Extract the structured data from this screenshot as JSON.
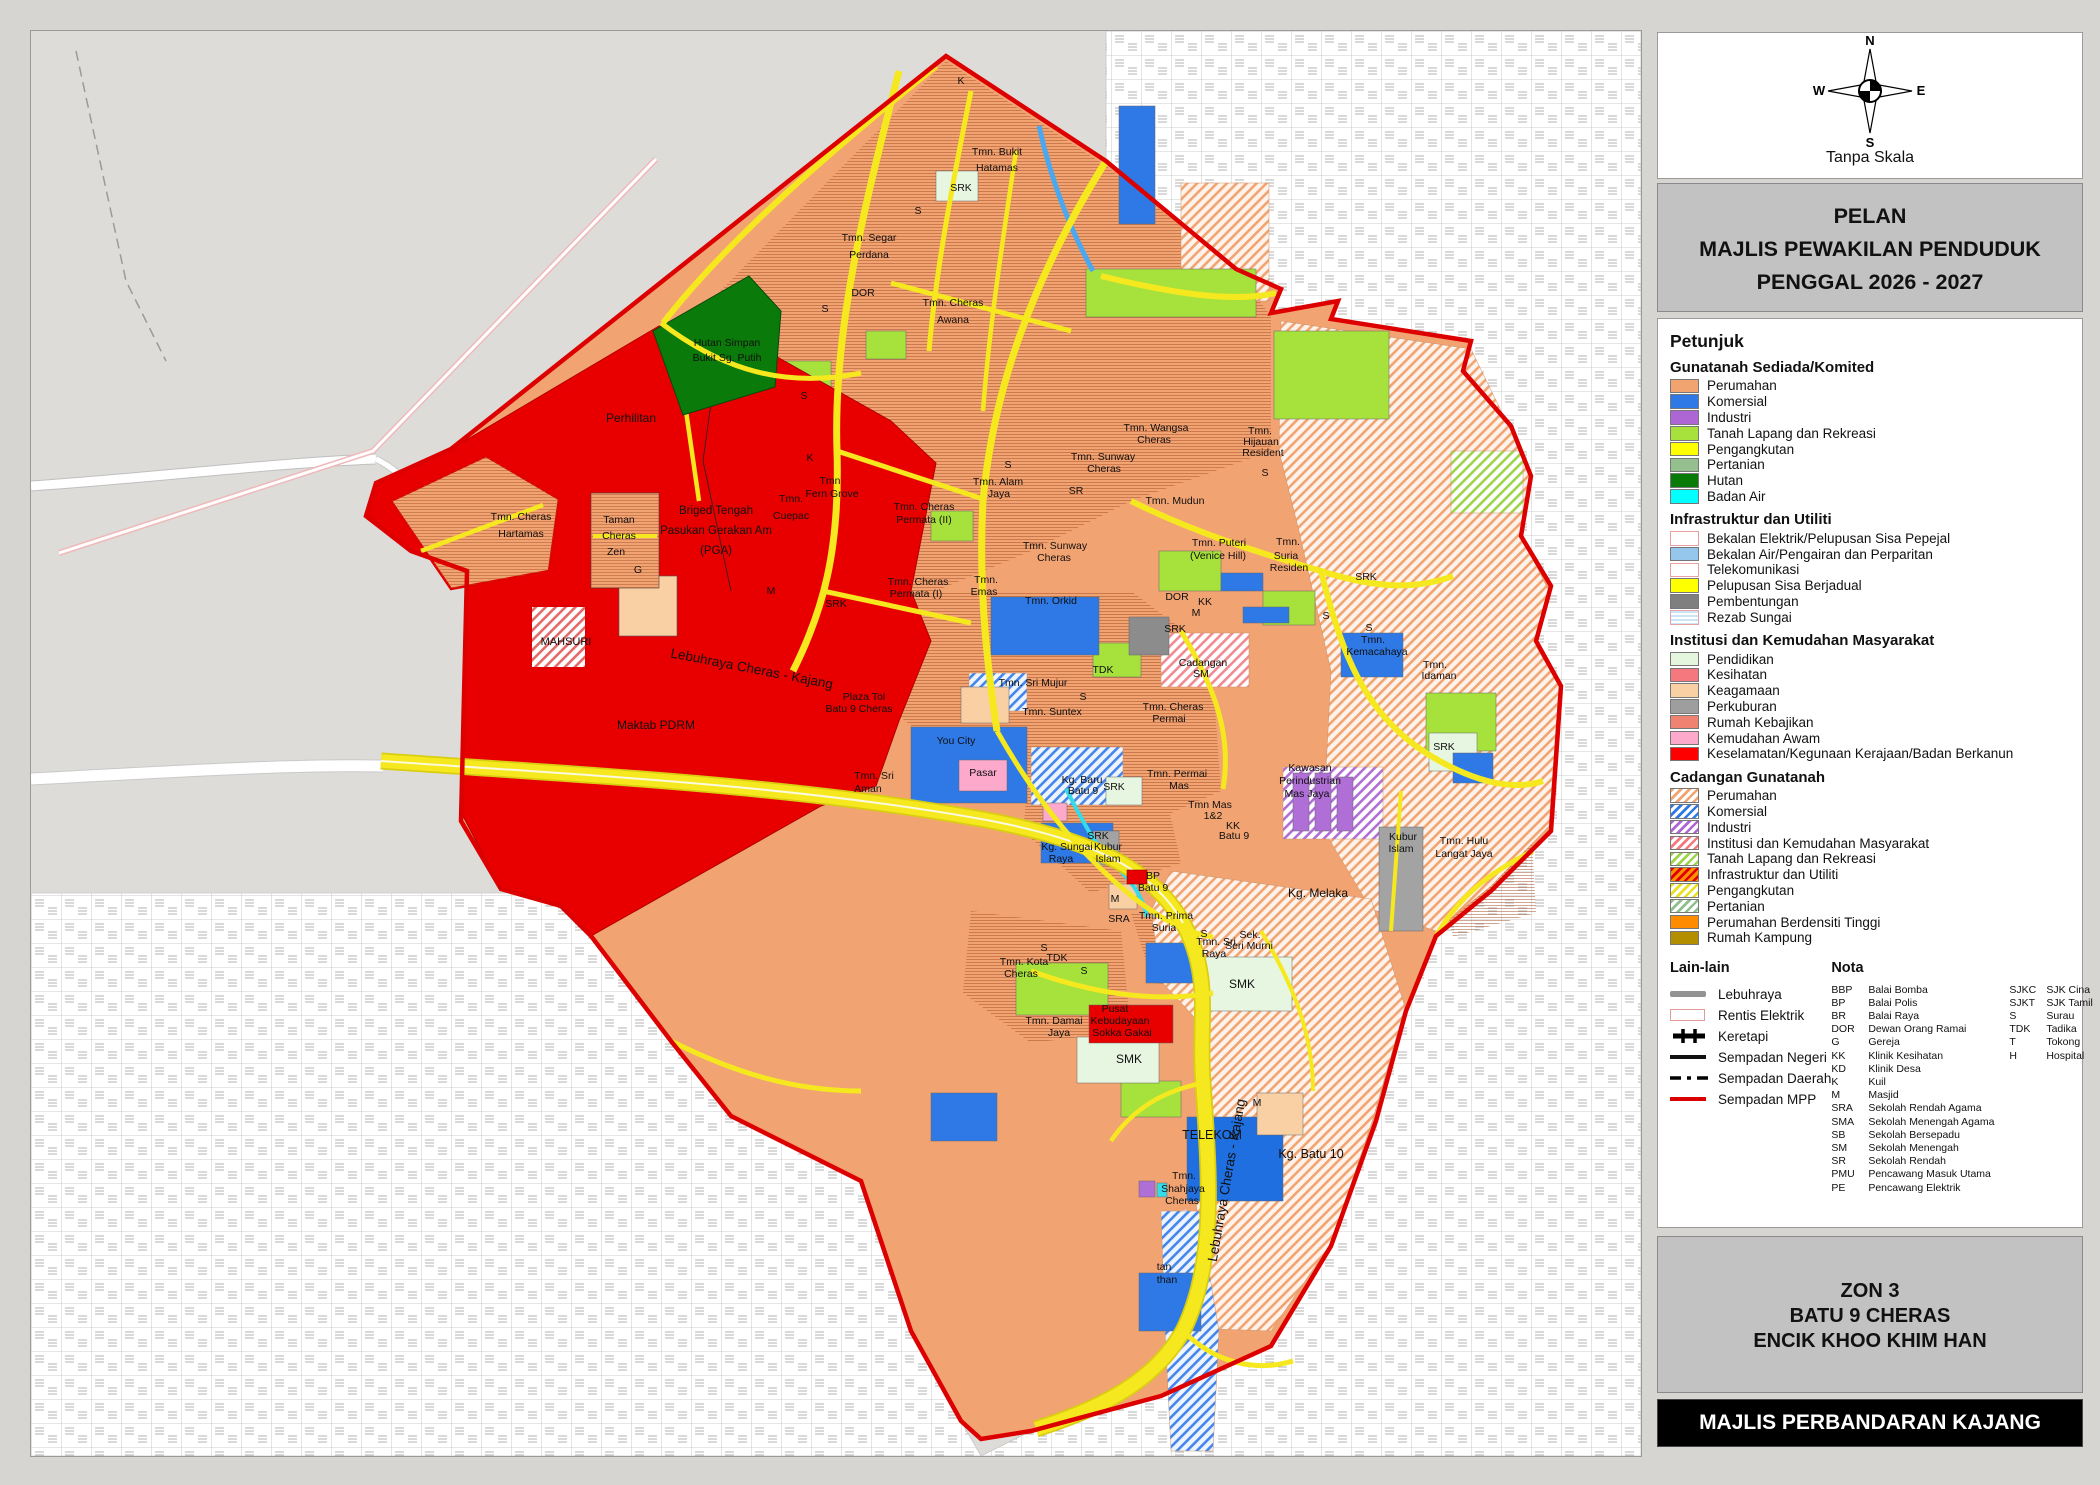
{
  "panel": {
    "compass": {
      "n": "N",
      "s": "S",
      "e": "E",
      "w": "W",
      "scale_note": "Tanpa Skala"
    },
    "title": {
      "line1": "PELAN",
      "line2": "MAJLIS PEWAKILAN PENDUDUK",
      "line3": "PENGGAL 2026 - 2027"
    },
    "legend": {
      "heading": "Petunjuk",
      "sections": [
        {
          "heading": "Gunatanah Sediada/Komited",
          "items": [
            {
              "label": "Perumahan",
              "swatch": {
                "t": "solid",
                "c": "#F2A470"
              }
            },
            {
              "label": "Komersial",
              "swatch": {
                "t": "solid",
                "c": "#2E79E6"
              }
            },
            {
              "label": "Industri",
              "swatch": {
                "t": "solid",
                "c": "#AE66D5"
              }
            },
            {
              "label": "Tanah Lapang dan Rekreasi",
              "swatch": {
                "t": "solid",
                "c": "#A6E23B"
              }
            },
            {
              "label": "Pengangkutan",
              "swatch": {
                "t": "solid",
                "c": "#FFFF00"
              }
            },
            {
              "label": "Pertanian",
              "swatch": {
                "t": "solid",
                "c": "#95BF8E"
              }
            },
            {
              "label": "Hutan",
              "swatch": {
                "t": "solid",
                "c": "#077A07"
              }
            },
            {
              "label": "Badan Air",
              "swatch": {
                "t": "solid",
                "c": "#00FFFF"
              }
            }
          ]
        },
        {
          "heading": "Infrastruktur dan Utiliti",
          "items": [
            {
              "label": "Bekalan Elektrik/Pelupusan Sisa Pepejal",
              "swatch": {
                "t": "outline"
              }
            },
            {
              "label": "Bekalan Air/Pengairan dan Perparitan",
              "swatch": {
                "t": "solid",
                "c": "#95C7EC"
              }
            },
            {
              "label": "Telekomunikasi",
              "swatch": {
                "t": "outline"
              }
            },
            {
              "label": "Pelupusan Sisa Berjadual",
              "swatch": {
                "t": "solid",
                "c": "#FFFF00"
              }
            },
            {
              "label": "Pembentungan",
              "swatch": {
                "t": "solid",
                "c": "#7F7F7F"
              }
            },
            {
              "label": "Rezab Sungai",
              "swatch": {
                "t": "hstripes"
              }
            }
          ]
        },
        {
          "heading": "Institusi dan Kemudahan Masyarakat",
          "items": [
            {
              "label": "Pendidikan",
              "swatch": {
                "t": "solid",
                "c": "#E4F6DE"
              }
            },
            {
              "label": "Kesihatan",
              "swatch": {
                "t": "solid",
                "c": "#F4787E"
              }
            },
            {
              "label": "Keagamaan",
              "swatch": {
                "t": "solid",
                "c": "#F9CFA4"
              }
            },
            {
              "label": "Perkuburan",
              "swatch": {
                "t": "solid",
                "c": "#9E9E9E"
              }
            },
            {
              "label": "Rumah Kebajikan",
              "swatch": {
                "t": "solid",
                "c": "#F08272"
              }
            },
            {
              "label": "Kemudahan Awam",
              "swatch": {
                "t": "solid",
                "c": "#FCA9CB"
              }
            },
            {
              "label": "Keselamatan/Kegunaan Kerajaan/Badan Berkanun",
              "swatch": {
                "t": "solid",
                "c": "#FE0000"
              }
            }
          ]
        },
        {
          "heading": "Cadangan Gunatanah",
          "items": [
            {
              "label": "Perumahan",
              "swatch": {
                "t": "hatch",
                "c": "#F2A470"
              }
            },
            {
              "label": "Komersial",
              "swatch": {
                "t": "hatch",
                "c": "#2E79E6"
              }
            },
            {
              "label": "Industri",
              "swatch": {
                "t": "hatch",
                "c": "#AE66D5"
              }
            },
            {
              "label": "Institusi dan Kemudahan Masyarakat",
              "swatch": {
                "t": "hatch",
                "c": "#F4787E"
              }
            },
            {
              "label": "Tanah Lapang dan Rekreasi",
              "swatch": {
                "t": "hatch",
                "c": "#9ED44A"
              }
            },
            {
              "label": "Infrastruktur dan Utiliti",
              "swatch": {
                "t": "hatch",
                "c": "#E00000",
                "bg": "#FF9000"
              }
            },
            {
              "label": "Pengangkutan",
              "swatch": {
                "t": "hatch",
                "c": "#E8E020"
              }
            },
            {
              "label": "Pertanian",
              "swatch": {
                "t": "hatch",
                "c": "#8FBF8E"
              }
            },
            {
              "label": "Perumahan Berdensiti Tinggi",
              "swatch": {
                "t": "solid",
                "c": "#FF8C00"
              }
            },
            {
              "label": "Rumah Kampung",
              "swatch": {
                "t": "solid",
                "c": "#B38F00"
              }
            }
          ]
        }
      ]
    },
    "lain_lain": {
      "heading": "Lain-lain",
      "items": [
        {
          "label": "Lebuhraya",
          "symbol": "highway"
        },
        {
          "label": "Rentis Elektrik",
          "symbol": "rentis"
        },
        {
          "label": "Keretapi",
          "symbol": "rail"
        },
        {
          "label": "Sempadan Negeri",
          "symbol": "negeri"
        },
        {
          "label": "Sempadan Daerah",
          "symbol": "daerah"
        },
        {
          "label": "Sempadan MPP",
          "symbol": "mpp"
        }
      ]
    },
    "nota": {
      "heading": "Nota",
      "col1": [
        [
          "BBP",
          "Balai Bomba"
        ],
        [
          "BP",
          "Balai Polis"
        ],
        [
          "BR",
          "Balai Raya"
        ],
        [
          "DOR",
          "Dewan Orang Ramai"
        ],
        [
          "G",
          "Gereja"
        ],
        [
          "KK",
          "Klinik Kesihatan"
        ],
        [
          "KD",
          "Klinik Desa"
        ],
        [
          "K",
          "Kuil"
        ],
        [
          "M",
          "Masjid"
        ],
        [
          "SRA",
          "Sekolah Rendah Agama"
        ],
        [
          "SMA",
          "Sekolah Menengah Agama"
        ],
        [
          "SB",
          "Sekolah Bersepadu"
        ],
        [
          "SM",
          "Sekolah Menengah"
        ],
        [
          "SR",
          "Sekolah Rendah"
        ],
        [
          "PMU",
          "Pencawang Masuk Utama"
        ],
        [
          "PE",
          "Pencawang Elektrik"
        ]
      ],
      "col2": [
        [
          "SJKC",
          "SJK Cina"
        ],
        [
          "SJKT",
          "SJK Tamil"
        ],
        [
          "S",
          "Surau"
        ],
        [
          "TDK",
          "Tadika"
        ],
        [
          "T",
          "Tokong"
        ],
        [
          "H",
          "Hospital"
        ]
      ]
    },
    "zone_box": {
      "line1": "ZON 3",
      "line2": "BATU 9 CHERAS",
      "line3": "ENCIK KHOO KHIM HAN"
    },
    "footer": "MAJLIS PERBANDARAN KAJANG"
  },
  "map": {
    "labels": [
      [
        "K",
        930,
        53
      ],
      [
        "Tmn. Bukit",
        966,
        124
      ],
      [
        "Hatamas",
        966,
        140
      ],
      [
        "SRK",
        930,
        160
      ],
      [
        "S",
        887,
        183
      ],
      [
        "Tmn. Segar",
        838,
        210
      ],
      [
        "Perdana",
        838,
        227
      ],
      [
        "DOR",
        832,
        265
      ],
      [
        "S",
        794,
        281
      ],
      [
        "Tmn. Cheras",
        922,
        275
      ],
      [
        "Awana",
        922,
        292
      ],
      [
        "Hutan Simpan",
        696,
        315
      ],
      [
        "Bukit Sg. Putih",
        696,
        330
      ],
      [
        "S",
        773,
        368
      ],
      [
        "Perhilitan",
        600,
        391,
        12
      ],
      [
        "Tmn. Cheras",
        490,
        489
      ],
      [
        "Hartamas",
        490,
        506
      ],
      [
        "Taman",
        588,
        492
      ],
      [
        "Cheras",
        588,
        508
      ],
      [
        "Zen",
        585,
        524
      ],
      [
        "G",
        607,
        542
      ],
      [
        "Briged Tengah",
        685,
        483,
        11.5
      ],
      [
        "Pasukan Gerakan Am",
        685,
        503,
        11.5
      ],
      [
        "(PGA)",
        685,
        523,
        11.5
      ],
      [
        "MAHSURI",
        535,
        614,
        11
      ],
      [
        "Maktab PDRM",
        625,
        698,
        12
      ],
      [
        "Lebuhraya Cheras - Kajang",
        720,
        642,
        13.5,
        11
      ],
      [
        "Tmn.",
        760,
        471
      ],
      [
        "Cuepac",
        760,
        488
      ],
      [
        "K",
        779,
        430
      ],
      [
        "Tmn",
        799,
        453
      ],
      [
        "Fern Grove",
        801,
        466
      ],
      [
        "Tmn. Cheras",
        893,
        479
      ],
      [
        "Permata (II)",
        893,
        492
      ],
      [
        "S",
        977,
        437
      ],
      [
        "Tmn. Alam",
        967,
        454
      ],
      [
        "Jaya",
        968,
        466
      ],
      [
        "SR",
        1045,
        463
      ],
      [
        "Tmn. Sunway",
        1024,
        518
      ],
      [
        "Cheras",
        1023,
        530
      ],
      [
        "Tmn.",
        955,
        552
      ],
      [
        "Emas",
        953,
        564
      ],
      [
        "Tmn. Orkid",
        1020,
        573
      ],
      [
        "SRK",
        805,
        576
      ],
      [
        "M",
        740,
        563
      ],
      [
        "Tmn. Wangsa",
        1125,
        400
      ],
      [
        "Cheras",
        1123,
        412
      ],
      [
        "Tmn. Sunway",
        1072,
        429
      ],
      [
        "Cheras",
        1073,
        441
      ],
      [
        "Tmn.",
        1229,
        403
      ],
      [
        "Hijauan",
        1230,
        414
      ],
      [
        "Resident",
        1232,
        425
      ],
      [
        "S",
        1234,
        445
      ],
      [
        "Tmn. Mudun",
        1144,
        473
      ],
      [
        "Tmn. Puteri",
        1188,
        515
      ],
      [
        "(Venice Hill)",
        1187,
        528
      ],
      [
        "Tmn.",
        1257,
        514
      ],
      [
        "Suria",
        1255,
        528
      ],
      [
        "Residen",
        1258,
        540
      ],
      [
        "SRK",
        1335,
        549
      ],
      [
        "DOR",
        1146,
        569
      ],
      [
        "KK",
        1174,
        574
      ],
      [
        "M",
        1165,
        585
      ],
      [
        "SRK",
        1144,
        601
      ],
      [
        "S",
        1295,
        588
      ],
      [
        "S",
        1338,
        600
      ],
      [
        "Tmn.",
        1342,
        612
      ],
      [
        "Kemacahaya",
        1346,
        624
      ],
      [
        "Tmn.",
        1404,
        637
      ],
      [
        "Idaman",
        1408,
        648
      ],
      [
        "Cadangan",
        1172,
        635
      ],
      [
        "SM",
        1170,
        646
      ],
      [
        "TDK",
        1072,
        642
      ],
      [
        "Tmn. Cheras",
        887,
        554
      ],
      [
        "Permata (I)",
        885,
        566
      ],
      [
        "Plaza Tol",
        833,
        669
      ],
      [
        "Batu 9 Cheras",
        828,
        681
      ],
      [
        "Tmn. Sri Mujur",
        1002,
        655
      ],
      [
        "S",
        1052,
        669
      ],
      [
        "Tmn. Suntex",
        1021,
        684
      ],
      [
        "Tmn. Cheras",
        1142,
        679
      ],
      [
        "Permai",
        1138,
        691
      ],
      [
        "You City",
        925,
        713
      ],
      [
        "Pasar",
        952,
        745
      ],
      [
        "Tmn. Sri",
        843,
        748
      ],
      [
        "Aman",
        837,
        761
      ],
      [
        "Kg. Baru",
        1051,
        752
      ],
      [
        "Batu 9",
        1052,
        763
      ],
      [
        "SRK",
        1083,
        759
      ],
      [
        "Tmn. Permai",
        1146,
        746
      ],
      [
        "Mas",
        1148,
        758
      ],
      [
        "Tmn Mas",
        1179,
        777
      ],
      [
        "1&2",
        1182,
        788
      ],
      [
        "KK",
        1202,
        798
      ],
      [
        "Batu 9",
        1203,
        808
      ],
      [
        "SRK",
        1067,
        808
      ],
      [
        "Kg. Sungai",
        1036,
        819
      ],
      [
        "Raya",
        1030,
        831
      ],
      [
        "Kubur",
        1077,
        819
      ],
      [
        "Islam",
        1077,
        831
      ],
      [
        "BP",
        1122,
        848
      ],
      [
        "Batu 9",
        1122,
        860
      ],
      [
        "M",
        1084,
        871
      ],
      [
        "SRK",
        1413,
        719
      ],
      [
        "Kawasan",
        1279,
        740
      ],
      [
        "Perindustrian",
        1279,
        753
      ],
      [
        "Mas Jaya",
        1276,
        766
      ],
      [
        "Kubur",
        1372,
        809
      ],
      [
        "Islam",
        1370,
        821
      ],
      [
        "Tmn. Hulu",
        1433,
        813
      ],
      [
        "Langat Jaya",
        1433,
        826
      ],
      [
        "Kg. Melaka",
        1287,
        866,
        12
      ],
      [
        "SRA",
        1088,
        891
      ],
      [
        "Tmn. Prima",
        1135,
        888
      ],
      [
        "Suria",
        1133,
        900
      ],
      [
        "S",
        1173,
        906
      ],
      [
        "Tmn. Sri",
        1185,
        914
      ],
      [
        "Raya",
        1183,
        926
      ],
      [
        "Sek.",
        1219,
        907
      ],
      [
        "Seri Murni",
        1218,
        918
      ],
      [
        "SMK",
        1211,
        957,
        12
      ],
      [
        "S",
        1013,
        920
      ],
      [
        "TDK",
        1026,
        930
      ],
      [
        "S",
        1053,
        943
      ],
      [
        "Tmn. Kota",
        993,
        934
      ],
      [
        "Cheras",
        990,
        946
      ],
      [
        "Tmn. Damai",
        1023,
        993
      ],
      [
        "Jaya",
        1028,
        1005
      ],
      [
        "Pusat",
        1084,
        981
      ],
      [
        "Kebudayaan",
        1089,
        993
      ],
      [
        "Sokka Gakai",
        1091,
        1005
      ],
      [
        "SMK",
        1098,
        1032,
        12
      ],
      [
        "M",
        1226,
        1075
      ],
      [
        "TELEKOM",
        1181,
        1108,
        12.5
      ],
      [
        "Kg. Batu 10",
        1280,
        1127,
        12.5
      ],
      [
        "Tmn.",
        1153,
        1148
      ],
      [
        "Shahjaya",
        1152,
        1161
      ],
      [
        "Cheras",
        1151,
        1173
      ],
      [
        "Lebuhraya Cheras - Kajang",
        1200,
        1150,
        13.5,
        -80
      ],
      [
        "tan",
        1133,
        1239
      ],
      [
        "than",
        1136,
        1252
      ]
    ]
  }
}
